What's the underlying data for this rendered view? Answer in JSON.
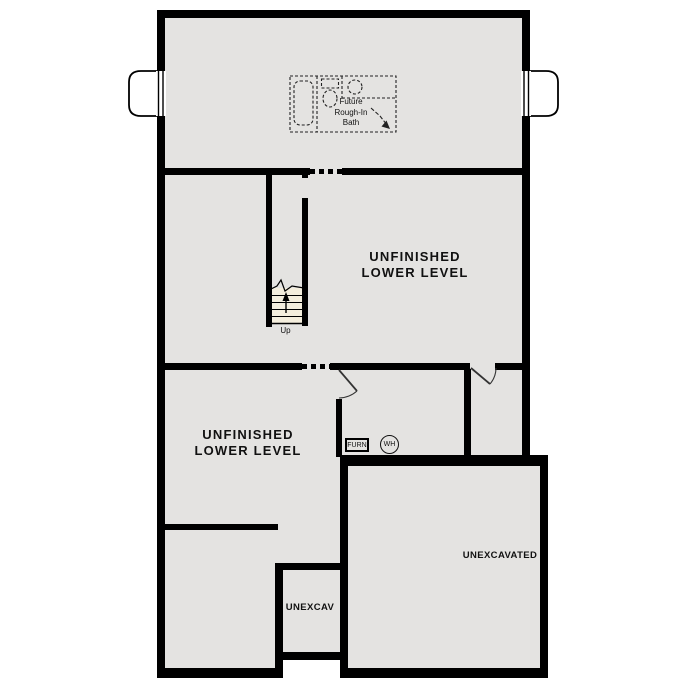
{
  "document": {
    "type": "floor-plan",
    "level": "Lower Level"
  },
  "colors": {
    "wall": "#000000",
    "floor": "#e4e3e1",
    "stair": "#f4eedd",
    "background": "#ffffff",
    "text": "#111111"
  },
  "rooms": {
    "unfinished_north": {
      "label_line1": "UNFINISHED",
      "label_line2": "LOWER LEVEL"
    },
    "unfinished_southwest": {
      "label_line1": "UNFINISHED",
      "label_line2": "LOWER LEVEL"
    },
    "unexcavated_large": {
      "label": "UNEXCAVATED"
    },
    "unexcavated_small": {
      "label": "UNEXCAV"
    }
  },
  "features": {
    "future_bath": {
      "line1": "Future",
      "line2": "Rough-In",
      "line3": "Bath"
    },
    "stairs": {
      "label": "Up"
    },
    "furnace": {
      "label": "FURN"
    },
    "water_heater": {
      "label": "WH"
    }
  }
}
